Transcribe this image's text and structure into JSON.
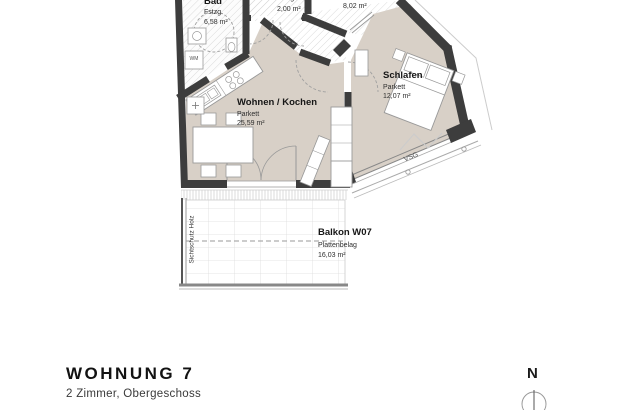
{
  "plan": {
    "rooms": {
      "bad": {
        "name": "Bad",
        "finish": "Fstzg.",
        "area": "6,58 m²"
      },
      "room_2_00": {
        "name": "",
        "finish": "Fstzg.",
        "area": "2,00 m²"
      },
      "room_8_02": {
        "name": "",
        "finish": "Fstzg.",
        "area": "8,02 m²"
      },
      "wohnen": {
        "name": "Wohnen / Kochen",
        "finish": "Parkett",
        "area": "25,59 m²"
      },
      "schlafen": {
        "name": "Schlafen",
        "finish": "Parkett",
        "area": "12,07 m²"
      },
      "balkon": {
        "name": "Balkon W07",
        "finish": "Plattenbelag",
        "area": "16,03 m²"
      }
    },
    "annotations": {
      "glazing": "VSG",
      "privacy_screen": "Sichtschutz Holz",
      "washer": "WM"
    },
    "compass": {
      "north": "N"
    },
    "colors": {
      "wall": "#3d3d3d",
      "floor_parquet": "#d8d0c7",
      "outline": "#999999"
    }
  },
  "title_block": {
    "title": "WOHNUNG 7",
    "subtitle": "2 Zimmer, Obergeschoss"
  }
}
